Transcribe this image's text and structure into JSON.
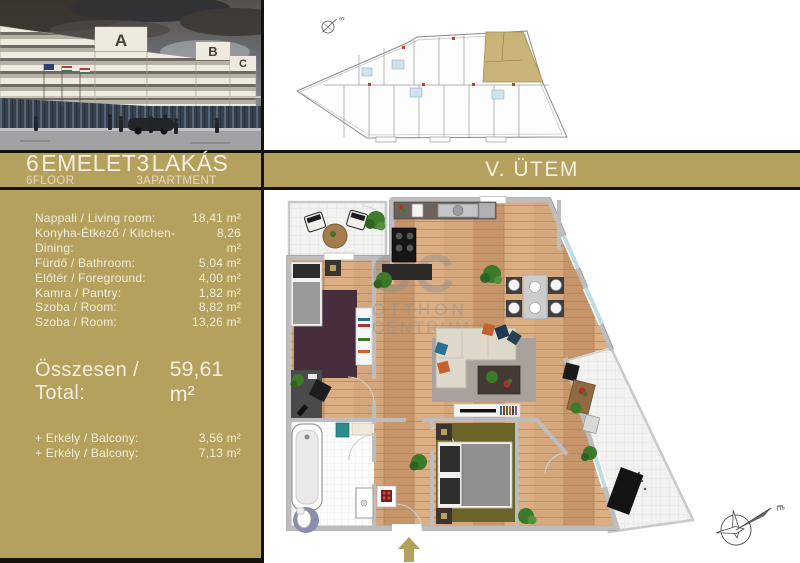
{
  "band": {
    "floor_number": "6",
    "floor_label": "EMELET",
    "floor_sub": "6FLOOR",
    "apartment_number": "3",
    "apartment_label": "LAKÁS",
    "apartment_sub": "3APARTMENT",
    "phase": "V. ÜTEM"
  },
  "areas": {
    "rows": [
      {
        "label": "Nappali / Living room:",
        "value": "18,41 m²"
      },
      {
        "label": "Konyha-Étkező / Kitchen-Dining:",
        "value": "8,26 m²"
      },
      {
        "label": "Fürdő / Bathroom:",
        "value": "5,04 m²"
      },
      {
        "label": "Előtér / Foreground:",
        "value": "4,00 m²"
      },
      {
        "label": "Kamra / Pantry:",
        "value": "1,82 m²"
      },
      {
        "label": "Szoba / Room:",
        "value": "8,82 m²"
      },
      {
        "label": "Szoba / Room:",
        "value": "13,26 m²"
      }
    ],
    "total": {
      "label": "Összesen / Total:",
      "value": "59,61 m²"
    },
    "extras": [
      {
        "label": "+ Erkély / Balcony:",
        "value": "3,56 m²"
      },
      {
        "label": "+ Erkély / Balcony:",
        "value": "7,13 m²"
      }
    ]
  },
  "watermark": {
    "initials": "OC",
    "line1": "OTTHON",
    "line2": "CENTRUM"
  },
  "compass": {
    "north": "É"
  },
  "photo": {
    "building_letters": [
      "A",
      "B",
      "C"
    ]
  },
  "colors": {
    "gold": "#b4a15d",
    "ink": "#15120c",
    "cream": "#f3eddd",
    "highlight_unit": "#c9b379"
  }
}
